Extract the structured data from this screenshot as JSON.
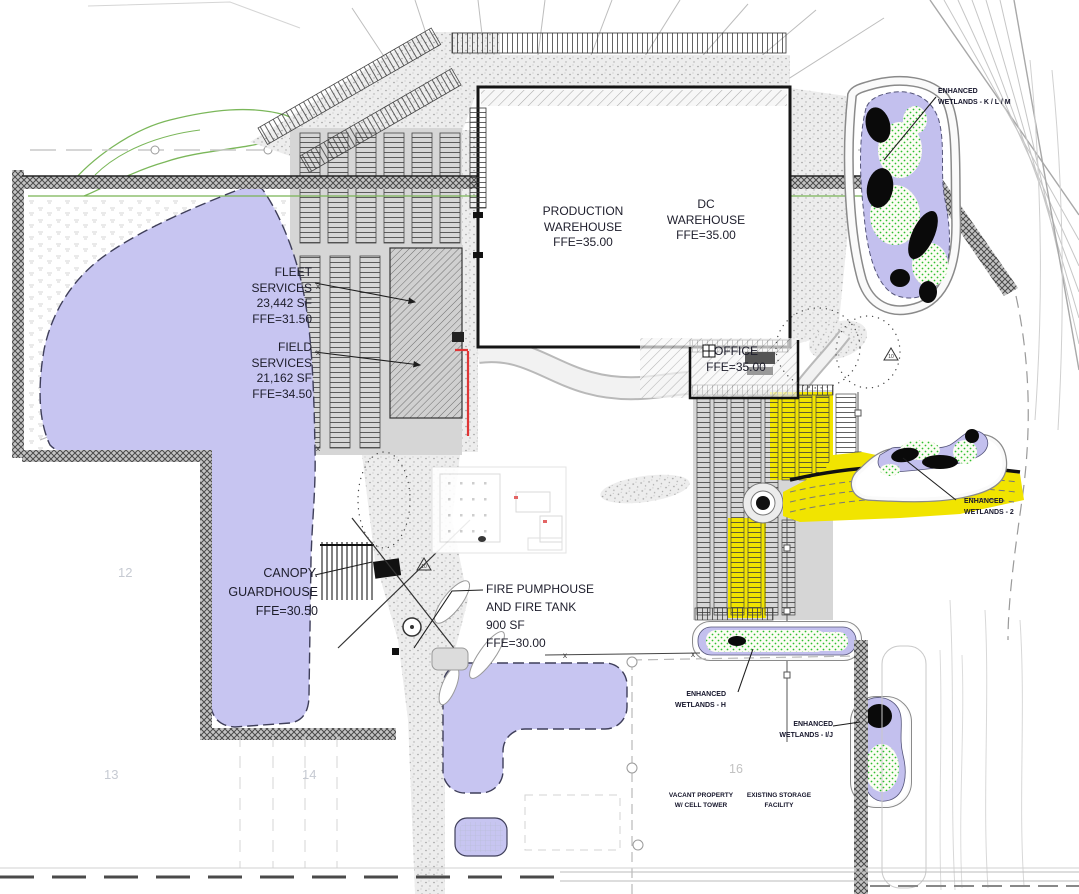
{
  "drawing": {
    "labels": {
      "production_warehouse": {
        "lines": [
          "PRODUCTION",
          "WAREHOUSE",
          "FFE=35.00"
        ]
      },
      "dc_warehouse": {
        "lines": [
          "DC",
          "WAREHOUSE",
          "FFE=35.00"
        ]
      },
      "fleet_services": {
        "lines": [
          "FLEET",
          "SERVICES",
          "23,442 SF",
          "FFE=31.50"
        ]
      },
      "field_services": {
        "lines": [
          "FIELD",
          "SERVICES",
          "21,162 SF",
          "FFE=34.50"
        ]
      },
      "office": {
        "lines": [
          "OFFICE",
          "FFE=35.00"
        ]
      },
      "canopy_guardhouse": {
        "lines": [
          "CANOPY.",
          "GUARDHOUSE",
          "FFE=30.50"
        ]
      },
      "fire_pumphouse": {
        "lines": [
          "FIRE PUMPHOUSE",
          "AND FIRE TANK",
          "900 SF",
          "FFE=30.00"
        ]
      },
      "wetlands_klm": {
        "lines": [
          "ENHANCED",
          "WETLANDS - K / L / M"
        ]
      },
      "wetlands_2": {
        "lines": [
          "ENHANCED",
          "WETLANDS - 2"
        ]
      },
      "wetlands_h": {
        "lines": [
          "ENHANCED",
          "WETLANDS - H"
        ]
      },
      "wetlands_ij": {
        "lines": [
          "ENHANCED",
          "WETLANDS - I/J"
        ]
      },
      "vacant_property": {
        "lines": [
          "VACANT PROPERTY",
          "W/ CELL TOWER"
        ]
      },
      "existing_storage": {
        "lines": [
          "EXISTING STORAGE",
          "FACILITY"
        ]
      }
    },
    "parcels": {
      "p12": "12",
      "p13": "13",
      "p14": "14",
      "p16": "16"
    },
    "markers": {
      "revision_triangle": "10",
      "fence_x": "x"
    },
    "colors": {
      "pond": "#c7c5f1",
      "wetland_water": "#c3c0ee",
      "wetland_highlight_yellow": "#f1e400",
      "parking_gray": "#d6d6d6",
      "wetland_green_dots": "#2fbf2f",
      "redline": "#e03535"
    }
  }
}
